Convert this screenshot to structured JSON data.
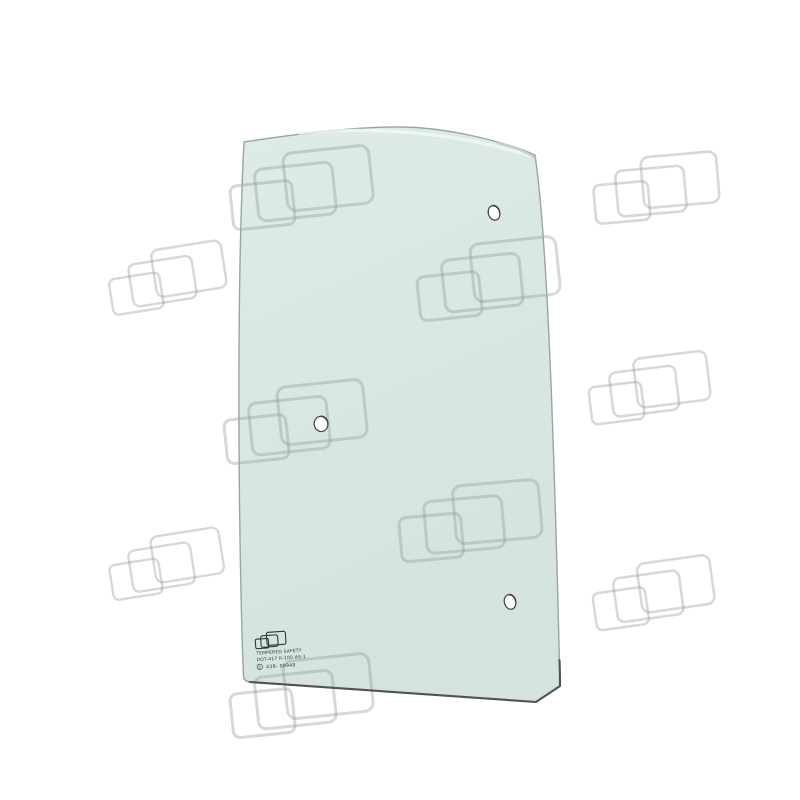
{
  "scene": {
    "description": "Product photo of a curved tempered-safety glass cab window panel (green tinted) with three mounting holes, shown on white background with tiled watermark logos",
    "background_color": "#ffffff",
    "glass_fill_top": "#deebe6",
    "glass_fill_bottom": "#d5e3dd",
    "glass_outline_color": "#9aa5a1",
    "glass_bottom_edge_color": "#50534f",
    "glass_top_highlight": "#f4f8f6",
    "watermark_stroke_color": "#8b9592",
    "watermark_stroke_opacity": 0.36,
    "hole_fill": "#ffffff",
    "hole_ring_color": "#3d433f",
    "stamp_ink_color": "#2e3734"
  },
  "stamp": {
    "logo_icon": "three-overlapping-rectangles-logo",
    "line1": "TEMPERED SAFETY",
    "line2": "DOT-417 R-100 AS-1",
    "line3_mark": "E",
    "line3": "43R- 00948"
  },
  "holes": [
    {
      "name": "top-right-hole",
      "cx": 494,
      "cy": 213,
      "rx": 5.6,
      "ry": 7.4,
      "angle": -20
    },
    {
      "name": "middle-left-hole",
      "cx": 321,
      "cy": 424,
      "rx": 6.8,
      "ry": 7.6,
      "angle": -12
    },
    {
      "name": "bottom-right-hole",
      "cx": 510,
      "cy": 602,
      "rx": 5.6,
      "ry": 7.4,
      "angle": -18
    }
  ],
  "watermarks": [
    {
      "x": 230,
      "y": 152,
      "scale": 1.0,
      "angle": -6
    },
    {
      "x": 585,
      "y": 152,
      "scale": 0.88,
      "angle": -5
    },
    {
      "x": 96,
      "y": 242,
      "scale": 0.82,
      "angle": -9
    },
    {
      "x": 417,
      "y": 243,
      "scale": 1.0,
      "angle": -6
    },
    {
      "x": 224,
      "y": 386,
      "scale": 1.0,
      "angle": -6
    },
    {
      "x": 578,
      "y": 352,
      "scale": 0.85,
      "angle": -7
    },
    {
      "x": 399,
      "y": 485,
      "scale": 1.0,
      "angle": -5
    },
    {
      "x": 95,
      "y": 528,
      "scale": 0.8,
      "angle": -9
    },
    {
      "x": 582,
      "y": 557,
      "scale": 0.85,
      "angle": -8
    },
    {
      "x": 230,
      "y": 660,
      "scale": 1.0,
      "angle": -6
    }
  ],
  "watermark_shape": {
    "rects": [
      {
        "x": 0,
        "y": 27,
        "w": 62,
        "h": 44,
        "rx": 7
      },
      {
        "x": 26,
        "y": 13,
        "w": 78,
        "h": 52,
        "rx": 8
      },
      {
        "x": 56,
        "y": 0,
        "w": 86,
        "h": 58,
        "rx": 9
      }
    ],
    "stroke_width": 3
  }
}
